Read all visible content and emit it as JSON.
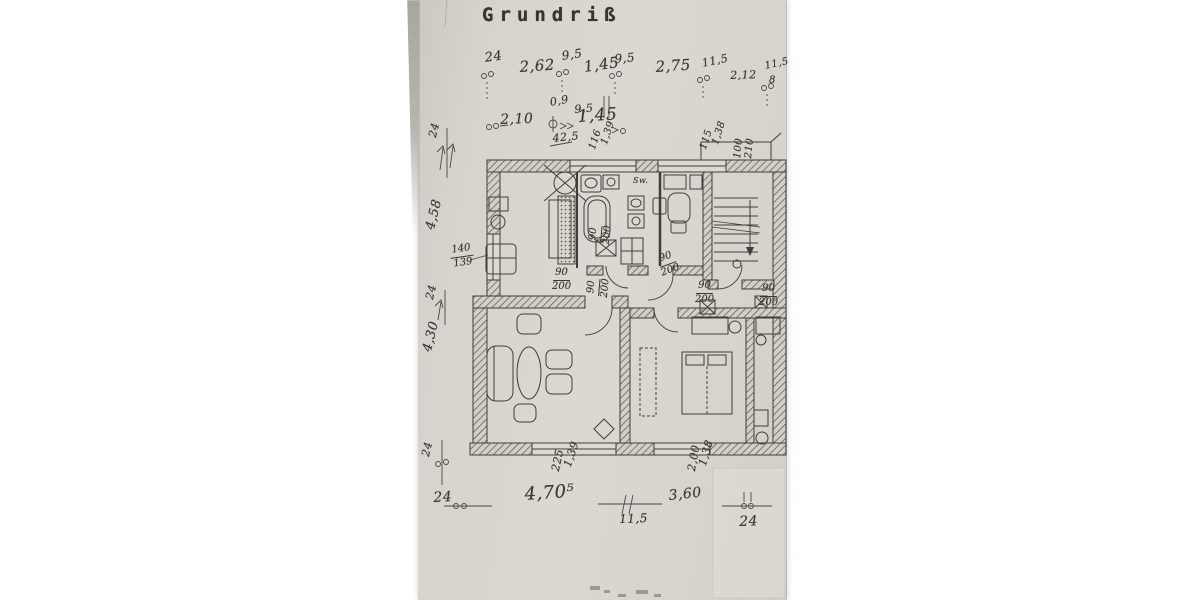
{
  "meta": {
    "title": "Grundriß"
  },
  "colors": {
    "paper": "#d8d5cf",
    "ink": "#403e3a",
    "hatch": "#56544f",
    "faint": "#c9c6c0"
  },
  "annotations": [
    {
      "n": "dim-24-top",
      "t": "24",
      "x": 484,
      "y": 52,
      "r": -8,
      "s": 13
    },
    {
      "n": "dim-2-62",
      "t": "2,62",
      "x": 519,
      "y": 60,
      "r": -4,
      "s": 15
    },
    {
      "n": "dim-9-5-a",
      "t": "9,5",
      "x": 561,
      "y": 50,
      "r": -8,
      "s": 12
    },
    {
      "n": "dim-1-45-a",
      "t": "1,45",
      "x": 583,
      "y": 60,
      "r": -8,
      "s": 15
    },
    {
      "n": "dim-9-5-b",
      "t": "9,5",
      "x": 614,
      "y": 53,
      "r": -5,
      "s": 12
    },
    {
      "n": "dim-2-75",
      "t": "2,75",
      "x": 655,
      "y": 60,
      "r": -4,
      "s": 15
    },
    {
      "n": "dim-11-5-a",
      "t": "11,5",
      "x": 701,
      "y": 58,
      "r": -12,
      "s": 11
    },
    {
      "n": "dim-2-12",
      "t": "2,12",
      "x": 730,
      "y": 70,
      "r": -2,
      "s": 11
    },
    {
      "n": "dim-11-5-b",
      "t": "11,5",
      "x": 764,
      "y": 62,
      "r": -12,
      "s": 10
    },
    {
      "n": "dim-8",
      "t": "8",
      "x": 769,
      "y": 76,
      "r": 0,
      "s": 10
    },
    {
      "n": "dim-0-9",
      "t": "0,9",
      "x": 549,
      "y": 97,
      "r": -10,
      "s": 11
    },
    {
      "n": "dim-9-5-c",
      "t": "9,5",
      "x": 574,
      "y": 104,
      "r": -5,
      "s": 11
    },
    {
      "n": "dim-2-10",
      "t": "2,10",
      "x": 500,
      "y": 113,
      "r": -2,
      "s": 14
    },
    {
      "n": "dim-1-45-b",
      "t": "1,45",
      "x": 577,
      "y": 109,
      "r": -4,
      "s": 17
    },
    {
      "n": "dim-42-5",
      "t": "42,5",
      "x": 552,
      "y": 133,
      "r": -6,
      "s": 11
    },
    {
      "n": "win-116",
      "t": "116",
      "x": 588,
      "y": 148,
      "r": -72,
      "s": 10
    },
    {
      "n": "win-1-39-a",
      "t": "1,39",
      "x": 600,
      "y": 143,
      "r": -72,
      "s": 10
    },
    {
      "n": "win-115",
      "t": "115",
      "x": 699,
      "y": 148,
      "r": -72,
      "s": 10
    },
    {
      "n": "win-1-38-a",
      "t": "1,38",
      "x": 711,
      "y": 143,
      "r": -72,
      "s": 10
    },
    {
      "n": "door-100",
      "t": "100",
      "x": 733,
      "y": 158,
      "r": -84,
      "s": 10
    },
    {
      "n": "door-210",
      "t": "210",
      "x": 744,
      "y": 158,
      "r": -84,
      "s": 10
    },
    {
      "n": "dim-24-left1",
      "t": "24",
      "x": 427,
      "y": 136,
      "r": -76,
      "s": 11
    },
    {
      "n": "dim-4-58",
      "t": "4,58",
      "x": 424,
      "y": 228,
      "r": -76,
      "s": 13
    },
    {
      "n": "dim-24-left2",
      "t": "24",
      "x": 424,
      "y": 298,
      "r": -76,
      "s": 11
    },
    {
      "n": "dim-4-30",
      "t": "4,30",
      "x": 421,
      "y": 350,
      "r": -76,
      "s": 13
    },
    {
      "n": "dim-24-left3",
      "t": "24",
      "x": 420,
      "y": 455,
      "r": -76,
      "s": 11
    },
    {
      "n": "win-225",
      "t": "225",
      "x": 550,
      "y": 470,
      "r": -78,
      "s": 11
    },
    {
      "n": "win-1-39-b",
      "t": "1,39",
      "x": 562,
      "y": 465,
      "r": -72,
      "s": 11
    },
    {
      "n": "win-2-00",
      "t": "2,00",
      "x": 686,
      "y": 470,
      "r": -80,
      "s": 11
    },
    {
      "n": "win-1-38-b",
      "t": "1,38",
      "x": 697,
      "y": 464,
      "r": -74,
      "s": 11
    },
    {
      "n": "dim-24-bot1",
      "t": "24",
      "x": 433,
      "y": 491,
      "r": -3,
      "s": 14
    },
    {
      "n": "dim-4-70-5",
      "t": "4,70⁵",
      "x": 524,
      "y": 486,
      "r": -4,
      "s": 18
    },
    {
      "n": "dim-11-5-c",
      "t": "11,5",
      "x": 619,
      "y": 513,
      "r": -2,
      "s": 12
    },
    {
      "n": "dim-3-60",
      "t": "3,60",
      "x": 668,
      "y": 489,
      "r": -6,
      "s": 14
    },
    {
      "n": "dim-24-bot2",
      "t": "24",
      "x": 739,
      "y": 515,
      "r": -2,
      "s": 14
    },
    {
      "n": "label-sw",
      "t": "Sw.",
      "x": 633,
      "y": 177,
      "r": 0,
      "s": 8
    }
  ],
  "fracs": [
    {
      "n": "win-140-139",
      "top": "140",
      "bot": "139",
      "x": 449,
      "y": 246,
      "r": -8,
      "s": 10
    },
    {
      "n": "door-90-200-a",
      "top": "90",
      "bot": "200",
      "x": 552,
      "y": 268,
      "r": 0,
      "s": 10
    },
    {
      "n": "door-90-200-b",
      "top": "90",
      "bot": "200",
      "x": 588,
      "y": 243,
      "r": -85,
      "s": 10
    },
    {
      "n": "door-90-200-c",
      "top": "90",
      "bot": "200",
      "x": 655,
      "y": 256,
      "r": -20,
      "s": 10
    },
    {
      "n": "door-90-200-d",
      "top": "90",
      "bot": "200",
      "x": 695,
      "y": 281,
      "r": 0,
      "s": 10
    },
    {
      "n": "door-90-200-e",
      "top": "90",
      "bot": "200",
      "x": 759,
      "y": 284,
      "r": 0,
      "s": 10
    },
    {
      "n": "door-90-200-f",
      "top": "90",
      "bot": "200",
      "x": 586,
      "y": 296,
      "r": -85,
      "s": 10
    }
  ]
}
